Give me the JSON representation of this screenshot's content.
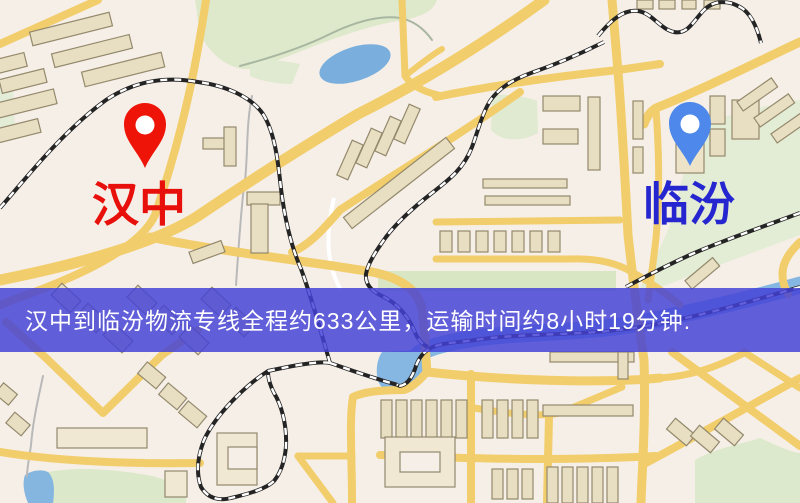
{
  "map": {
    "origin_label": "汉中",
    "destination_label": "临汾",
    "origin_label_color": "#e8100a",
    "destination_label_color": "#2526cf",
    "origin_marker_color": "#ee1508",
    "destination_marker_color": "#4d88ea"
  },
  "banner": {
    "text": "汉中到临汾物流专线全程约633公里，运输时间约8小时19分钟.",
    "text_color": "#ffffff",
    "background_color": "rgba(68,66,214,0.84)",
    "distance_km": "633",
    "duration_text": "8小时19分钟"
  }
}
